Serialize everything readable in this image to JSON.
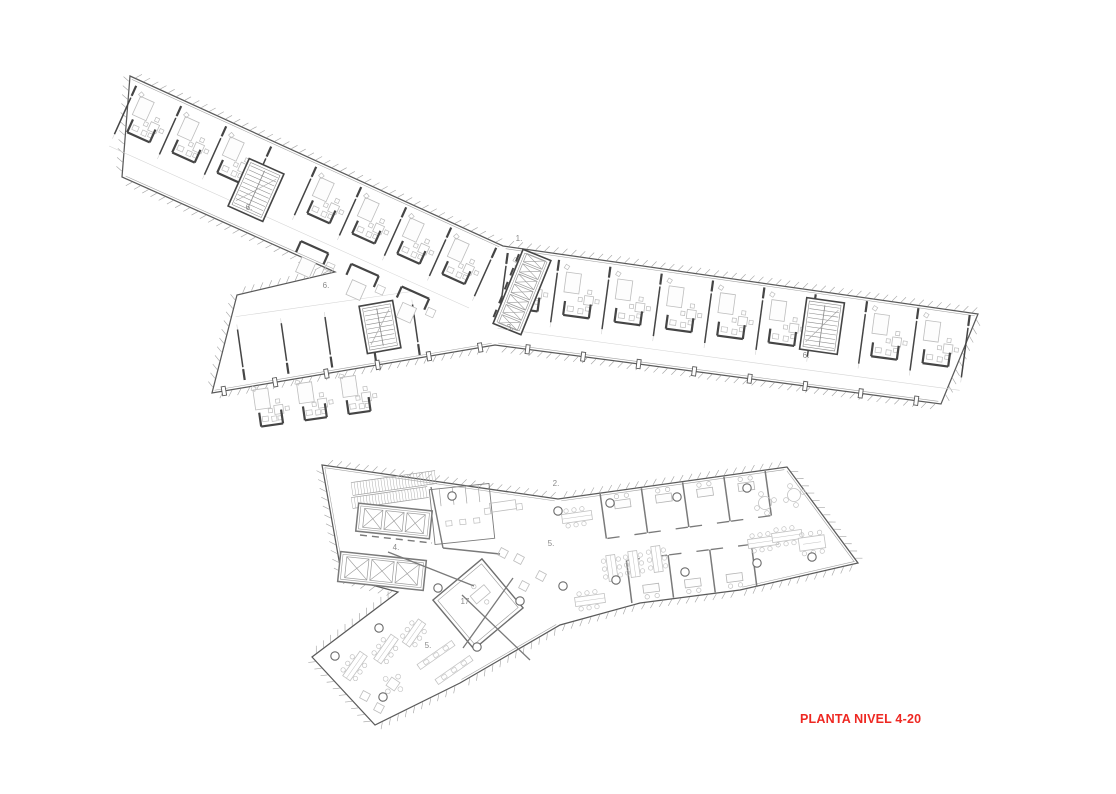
{
  "title": {
    "text": "PLANTA NIVEL 4-20",
    "color": "#ee2822"
  },
  "annotations": [
    {
      "text": "6.",
      "x": 249,
      "y": 210
    },
    {
      "text": "1.",
      "x": 519,
      "y": 241
    },
    {
      "text": "3.",
      "x": 510,
      "y": 330
    },
    {
      "text": "6.",
      "x": 326,
      "y": 288
    },
    {
      "text": "6.",
      "x": 806,
      "y": 358
    },
    {
      "text": "2.",
      "x": 556,
      "y": 486
    },
    {
      "text": "4.",
      "x": 396,
      "y": 550
    },
    {
      "text": "5.",
      "x": 551,
      "y": 546
    },
    {
      "text": "17.",
      "x": 466,
      "y": 604
    },
    {
      "text": "5.",
      "x": 428,
      "y": 648
    }
  ],
  "palette": {
    "background": "#ffffff",
    "outline": "#5a5a5a",
    "inner_line": "#9e9e9e",
    "hatch": "#a8a8a8",
    "wall_dark": "#454545",
    "wall_medium": "#7a7a7a",
    "furniture": "#bdbdbd",
    "faint": "#d4d4d4",
    "label": "#8a8a8a"
  }
}
